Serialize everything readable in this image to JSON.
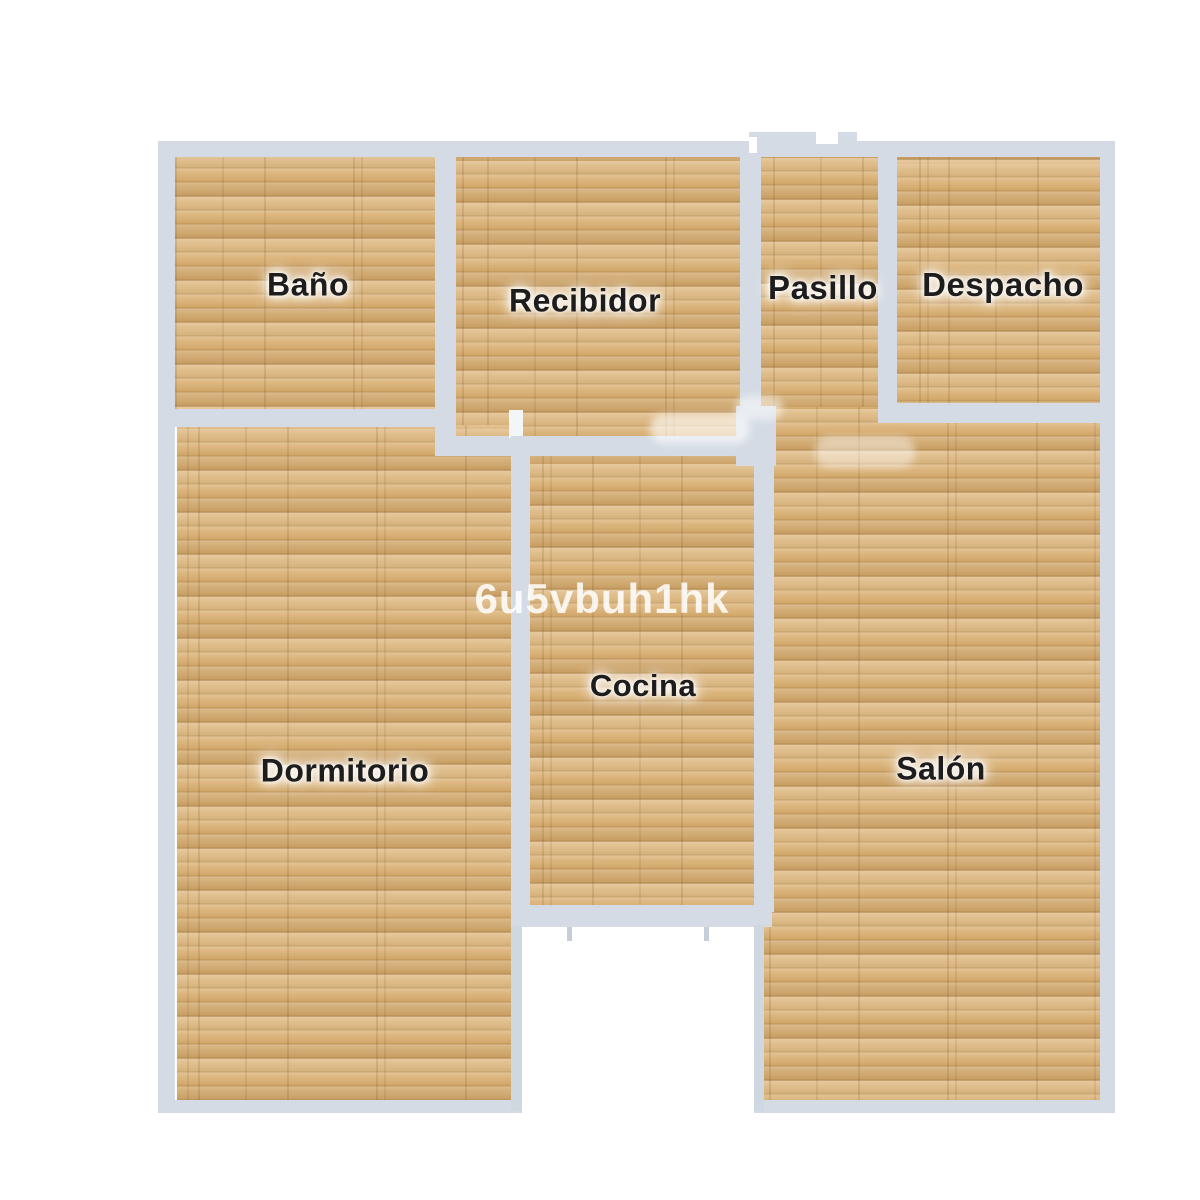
{
  "floorplan": {
    "rooms": {
      "bano": {
        "label": "Baño"
      },
      "recibidor": {
        "label": "Recibidor"
      },
      "pasillo": {
        "label": "Pasillo"
      },
      "despacho": {
        "label": "Despacho"
      },
      "dormitorio": {
        "label": "Dormitorio"
      },
      "cocina": {
        "label": "Cocina"
      },
      "salon": {
        "label": "Salón"
      }
    },
    "watermark": "6u5vbuh1hk",
    "colors": {
      "wall": "#d4dbe4",
      "wall_thin": "#cfd7e0",
      "floor_wood_base": "#dcb681",
      "label_text": "#1d1d1d",
      "background": "#ffffff"
    }
  }
}
